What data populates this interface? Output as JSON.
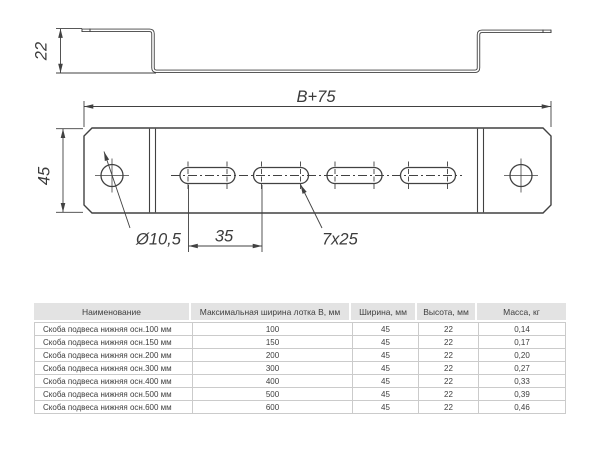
{
  "drawing": {
    "side_view": {
      "height_dim": "22"
    },
    "front_view": {
      "width_dim": "B+75",
      "height_dim": "45",
      "hole_dim": "Ø10,5",
      "pitch_dim": "35",
      "slot_dim": "7x25"
    },
    "line_color": "#414141"
  },
  "table": {
    "header_bg": "#e3e3e3",
    "border_color": "#cbcbcb",
    "headers": [
      "Наименование",
      "Максимальная ширина лотка В, мм",
      "Ширина, мм",
      "Высота, мм",
      "Масса, кг"
    ],
    "rows": [
      [
        "Скоба подвеса нижняя осн.100 мм",
        "100",
        "45",
        "22",
        "0,14"
      ],
      [
        "Скоба подвеса нижняя осн.150 мм",
        "150",
        "45",
        "22",
        "0,17"
      ],
      [
        "Скоба подвеса нижняя осн.200 мм",
        "200",
        "45",
        "22",
        "0,20"
      ],
      [
        "Скоба подвеса нижняя осн.300 мм",
        "300",
        "45",
        "22",
        "0,27"
      ],
      [
        "Скоба подвеса нижняя осн.400 мм",
        "400",
        "45",
        "22",
        "0,33"
      ],
      [
        "Скоба подвеса нижняя осн.500 мм",
        "500",
        "45",
        "22",
        "0,39"
      ],
      [
        "Скоба подвеса нижняя осн.600 мм",
        "600",
        "45",
        "22",
        "0,46"
      ]
    ]
  }
}
